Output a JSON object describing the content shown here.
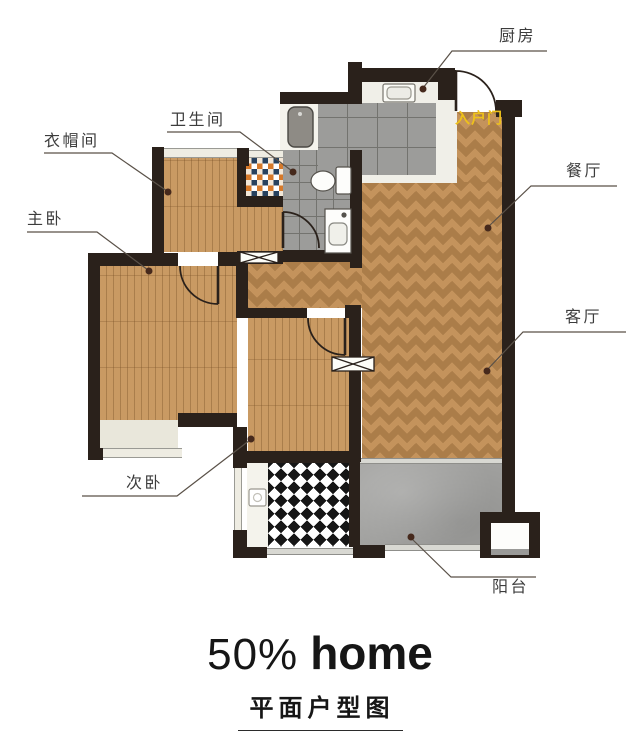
{
  "labels": {
    "kitchen": "厨房",
    "entrance": "入户门",
    "dining": "餐厅",
    "living": "客厅",
    "bathroom": "卫生间",
    "cloakroom": "衣帽间",
    "master": "主卧",
    "second": "次卧",
    "balcony": "阳台"
  },
  "brand": {
    "prefix": "50%",
    "name": "home",
    "caption": "平面户型图"
  },
  "colors": {
    "wall": "#2a211b",
    "wood_plank": "#c99a63",
    "wood_herringbone": "#c4935c",
    "tile_gray": "#9c9c9a",
    "grout": "#73736f",
    "concrete": "#a2a2a0",
    "marble": "#f0efe8",
    "mosaic_orange": "#d6792a",
    "mosaic_navy": "#27415e",
    "checker_black": "#161616",
    "entrance_label": "#eec11a",
    "label_text": "#3c3c3c",
    "leader": "#5a5148",
    "dot": "#46291c",
    "brand_text": "#161616"
  }
}
